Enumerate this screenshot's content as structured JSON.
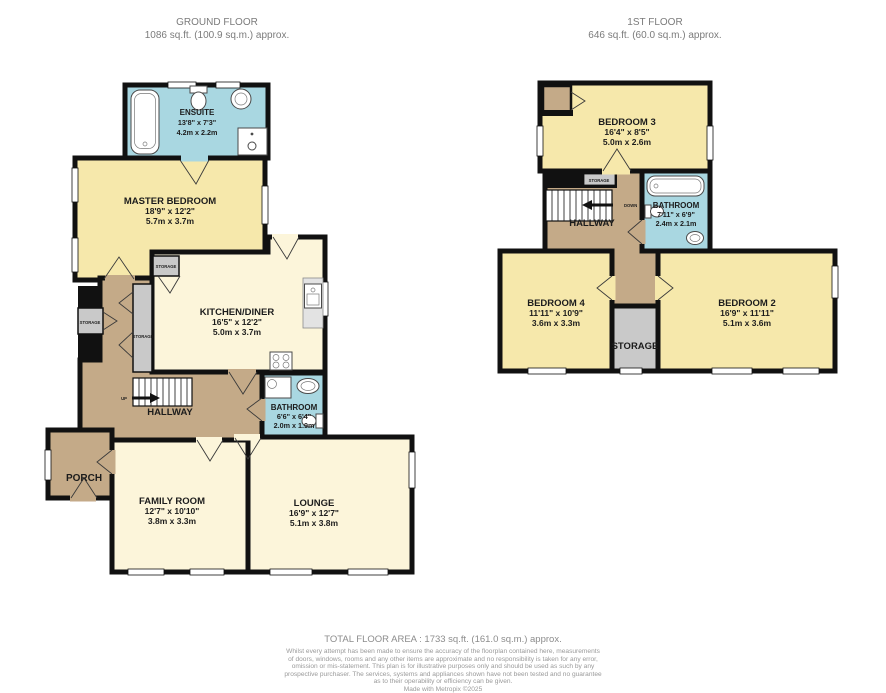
{
  "ground_floor": {
    "title": "GROUND FLOOR",
    "area": "1086 sq.ft. (100.9 sq.m.) approx.",
    "rooms": {
      "ensuite": {
        "name": "ENSUITE",
        "imperial": "13'8\" x 7'3\"",
        "metric": "4.2m x 2.2m"
      },
      "master_bedroom": {
        "name": "MASTER BEDROOM",
        "imperial": "18'9\" x 12'2\"",
        "metric": "5.7m x 3.7m"
      },
      "kitchen_diner": {
        "name": "KITCHEN/DINER",
        "imperial": "16'5\" x 12'2\"",
        "metric": "5.0m x 3.7m"
      },
      "bathroom": {
        "name": "BATHROOM",
        "imperial": "6'6\" x 6'4\"",
        "metric": "2.0m x 1.9m"
      },
      "family_room": {
        "name": "FAMILY ROOM",
        "imperial": "12'7\" x 10'10\"",
        "metric": "3.8m x 3.3m"
      },
      "lounge": {
        "name": "LOUNGE",
        "imperial": "16'9\" x 12'7\"",
        "metric": "5.1m x 3.8m"
      },
      "hallway": {
        "name": "HALLWAY"
      },
      "porch": {
        "name": "PORCH"
      }
    },
    "labels": {
      "up": "UP",
      "storage": "STORAGE"
    }
  },
  "first_floor": {
    "title": "1ST FLOOR",
    "area": "646 sq.ft. (60.0 sq.m.) approx.",
    "rooms": {
      "bedroom3": {
        "name": "BEDROOM 3",
        "imperial": "16'4\" x 8'5\"",
        "metric": "5.0m x 2.6m"
      },
      "bathroom": {
        "name": "BATHROOM",
        "imperial": "7'11\" x 6'9\"",
        "metric": "2.4m x 2.1m"
      },
      "bedroom4": {
        "name": "BEDROOM 4",
        "imperial": "11'11\" x 10'9\"",
        "metric": "3.6m x 3.3m"
      },
      "bedroom2": {
        "name": "BEDROOM 2",
        "imperial": "16'9\" x 11'11\"",
        "metric": "5.1m x 3.6m"
      },
      "storage": {
        "name": "STORAGE"
      },
      "hallway": {
        "name": "HALLWAY"
      }
    },
    "labels": {
      "down": "DOWN",
      "storage": "STORAGE"
    }
  },
  "footer": {
    "total": "TOTAL FLOOR AREA : 1733 sq.ft. (161.0 sq.m.) approx.",
    "disclaimer_lines": [
      "Whilst every attempt has been made to ensure the accuracy of the floorplan contained here, measurements",
      "of doors, windows, rooms and any other items are approximate and no responsibility is taken for any error,",
      "omission or mis-statement. This plan is for illustrative purposes only and should be used as such by any",
      "prospective purchaser. The services, systems and appliances shown have not been tested and no guarantee",
      "as to their operability or efficiency can be given.",
      "Made with Metropix ©2025"
    ]
  },
  "palette": {
    "bedroom_yellow": "#f6e8ab",
    "living_cream": "#fcf5da",
    "bathroom_blue": "#a9d7e1",
    "hallway_tan": "#c4aa88",
    "storage_gray": "#c9c9c9",
    "wall_black": "#111111"
  }
}
